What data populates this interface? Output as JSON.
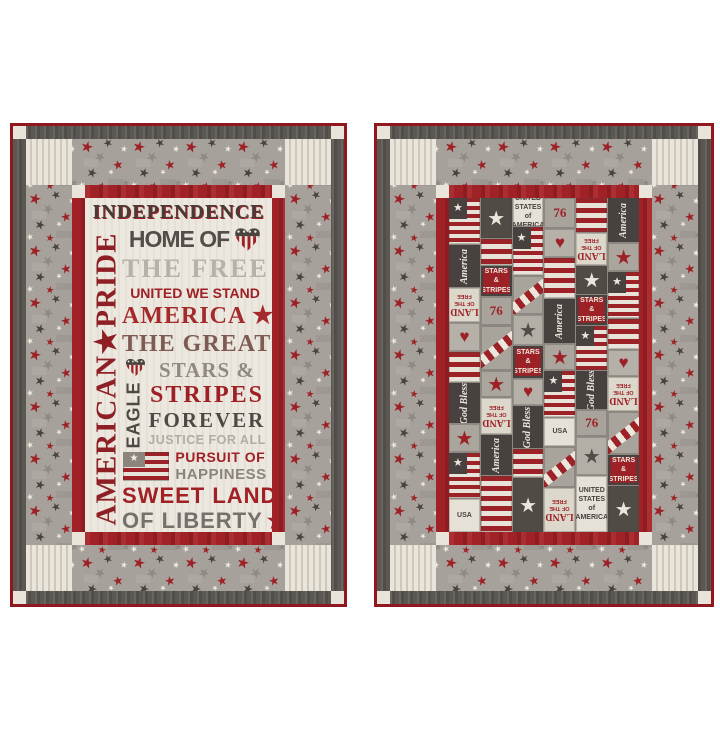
{
  "scene": {
    "background": "#ffffff",
    "description": "Two patriotic red, gray and cream quilts displayed side by side on white"
  },
  "colors": {
    "binding_red": "#8f171d",
    "border_red": "#a02126",
    "charcoal": "#5a5652",
    "star_fabric_gray": "#a6a19a",
    "cream": "#eae5db",
    "ticking_stripe": "#cfc8ba",
    "text_red": "#9e2025",
    "text_charcoal": "#4f4944",
    "text_light_gray": "#b2ada3"
  },
  "glyphs": {
    "star": "★",
    "heart": "♥"
  },
  "left_quilt": {
    "panel": {
      "vertical": "AMERICAN★PRIDE",
      "eagle": "EAGLE",
      "independence": "INDEPENDENCE",
      "home_of": "HOME OF",
      "the_free": "THE FREE",
      "united_we_stand": "UNITED WE STAND",
      "america": "AMERICA ★",
      "the_great": "THE GREAT",
      "stars_amp": "STARS &",
      "stripes": "STRIPES",
      "forever": "FOREVER",
      "justice": "JUSTICE FOR ALL",
      "pursuit_of": "PURSUIT OF",
      "happiness": "HAPPINESS",
      "sweet_land": "SWEET LAND",
      "of_liberty": "OF LIBERTY"
    }
  },
  "right_quilt": {
    "patchwork": {
      "columns": [
        [
          {
            "t": "flag",
            "h": 46
          },
          {
            "t": "script",
            "h": 42,
            "text": "America"
          },
          {
            "t": "land",
            "h": 34,
            "l1": "LAND",
            "l2": "OF THE FREE"
          },
          {
            "t": "heart",
            "h": 28
          },
          {
            "t": "stripesH",
            "h": 30
          },
          {
            "t": "script",
            "h": 40,
            "text": "God Bless"
          },
          {
            "t": "starRed",
            "h": 28
          },
          {
            "t": "flag",
            "h": 45
          },
          {
            "t": "txtCream",
            "h": 32,
            "text": "USA"
          }
        ],
        [
          {
            "t": "starWhite",
            "h": 40
          },
          {
            "t": "stripesH",
            "h": 26
          },
          {
            "t": "txtRed",
            "h": 30,
            "text": "STARS & STRIPES"
          },
          {
            "t": "six",
            "h": 28,
            "text": "76"
          },
          {
            "t": "ribbon",
            "h": 44
          },
          {
            "t": "starRed",
            "h": 26
          },
          {
            "t": "land",
            "h": 36,
            "l1": "LAND",
            "l2": "OF THE FREE"
          },
          {
            "t": "script",
            "h": 40,
            "text": "America"
          },
          {
            "t": "stripesH",
            "h": 55
          }
        ],
        [
          {
            "t": "txtCream",
            "h": 26,
            "text": "UNITED STATES of AMERICA"
          },
          {
            "t": "flag",
            "h": 48
          },
          {
            "t": "ribbon",
            "h": 38
          },
          {
            "t": "starGray",
            "h": 30
          },
          {
            "t": "txtRed",
            "h": 32,
            "text": "STARS & STRIPES"
          },
          {
            "t": "heart",
            "h": 26
          },
          {
            "t": "script",
            "h": 42,
            "text": "God Bless"
          },
          {
            "t": "stripesH",
            "h": 28
          },
          {
            "t": "starWhite",
            "h": 55
          }
        ],
        [
          {
            "t": "six",
            "h": 30,
            "text": "76"
          },
          {
            "t": "heart",
            "h": 28
          },
          {
            "t": "stripesH",
            "h": 40
          },
          {
            "t": "script",
            "h": 44,
            "text": "America"
          },
          {
            "t": "starRed",
            "h": 26
          },
          {
            "t": "flag",
            "h": 46
          },
          {
            "t": "txtCream",
            "h": 26,
            "text": "USA"
          },
          {
            "t": "ribbon",
            "h": 40
          },
          {
            "t": "land",
            "h": 45,
            "l1": "LAND",
            "l2": "OF THE FREE"
          }
        ],
        [
          {
            "t": "stripesH",
            "h": 34
          },
          {
            "t": "land",
            "h": 32,
            "l1": "LAND",
            "l2": "OF THE FREE"
          },
          {
            "t": "starWhite",
            "h": 28
          },
          {
            "t": "txtRed",
            "h": 30,
            "text": "STARS & STRIPES"
          },
          {
            "t": "flag",
            "h": 44
          },
          {
            "t": "script",
            "h": 38,
            "text": "God Bless"
          },
          {
            "t": "six",
            "h": 26,
            "text": "76"
          },
          {
            "t": "starGray",
            "h": 38
          },
          {
            "t": "txtCream",
            "h": 55,
            "text": "UNITED STATES of AMERICA"
          }
        ],
        [
          {
            "t": "script",
            "h": 44,
            "text": "America"
          },
          {
            "t": "starRed",
            "h": 28
          },
          {
            "t": "flag",
            "h": 46
          },
          {
            "t": "stripesH",
            "h": 30
          },
          {
            "t": "heart",
            "h": 26
          },
          {
            "t": "land",
            "h": 34,
            "l1": "LAND",
            "l2": "OF THE FREE"
          },
          {
            "t": "ribbon",
            "h": 42
          },
          {
            "t": "txtRed",
            "h": 30,
            "text": "STARS & STRIPES"
          },
          {
            "t": "starWhite",
            "h": 45
          }
        ]
      ]
    }
  }
}
